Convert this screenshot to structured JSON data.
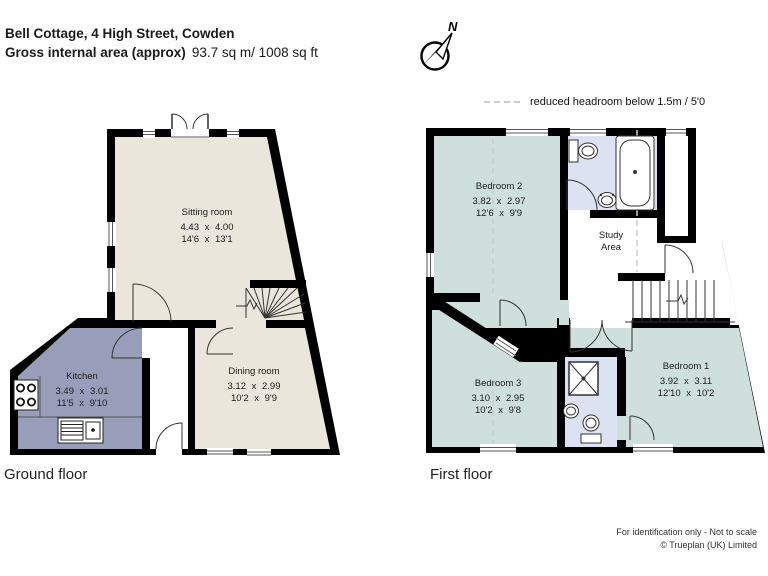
{
  "header": {
    "title": "Bell Cottage, 4 High Street, Cowden",
    "area_label": "Gross internal area (approx)",
    "area_value": "93.7 sq m/ 1008 sq ft"
  },
  "compass": {
    "label": "N"
  },
  "legend": {
    "text": "reduced headroom below 1.5m / 5'0"
  },
  "floors": {
    "ground": {
      "label": "Ground floor",
      "rooms": [
        {
          "name": "Sitting room",
          "metric": "4.43 x 4.00",
          "imperial": "14'6 x 13'1"
        },
        {
          "name": "Dining room",
          "metric": "3.12 x 2.99",
          "imperial": "10'2 x 9'9"
        },
        {
          "name": "Kitchen",
          "metric": "3.49 x 3.01",
          "imperial": "11'5 x 9'10"
        }
      ]
    },
    "first": {
      "label": "First floor",
      "rooms": [
        {
          "name": "Bedroom 2",
          "metric": "3.82 x 2.97",
          "imperial": "12'6 x 9'9"
        },
        {
          "name_line1": "Study",
          "name_line2": "Area"
        },
        {
          "name": "Bedroom 1",
          "metric": "3.92 x 3.11",
          "imperial": "12'10 x 10'2"
        },
        {
          "name": "Bedroom 3",
          "metric": "3.10 x 2.95",
          "imperial": "10'2 x 9'8"
        }
      ]
    }
  },
  "footer": {
    "line1": "For identification only - Not to scale",
    "line2": "© Trueplan (UK) Limited"
  },
  "colors": {
    "wall": "#000000",
    "reception_fill": "#eae6dc",
    "kitchen_fill": "#989eb9",
    "bedroom_fill": "#cfdfdb",
    "bathroom_fill": "#dde2f2",
    "reduced_headroom_dash": "#c7cdd7"
  }
}
